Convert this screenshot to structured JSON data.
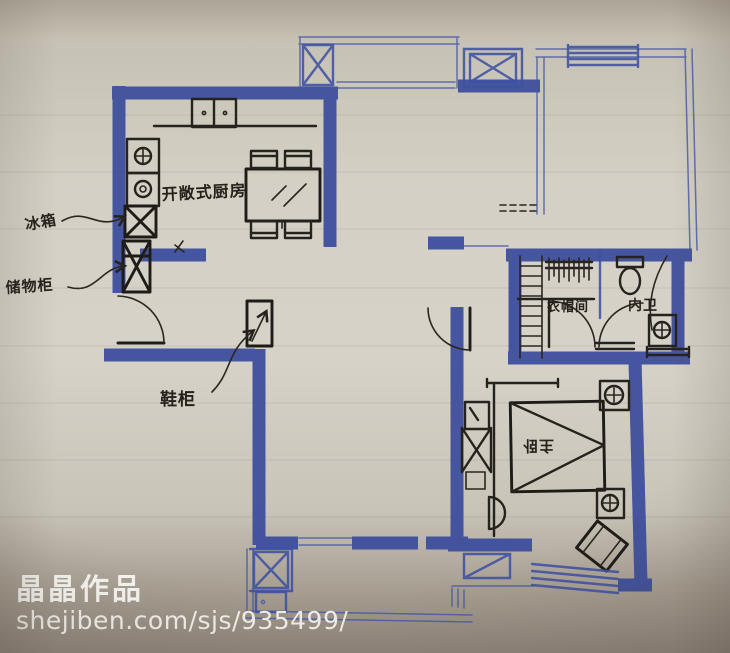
{
  "labels": {
    "kitchen": "开敞式厨房",
    "fridge": "冰箱",
    "storage_cabinet": "储物柜",
    "shoe_cabinet": "鞋柜",
    "walk_in_closet": "衣帽间",
    "inner_bathroom": "内卫",
    "master_bedroom": "主卧"
  },
  "watermark": {
    "title": "晶晶作品",
    "url": "shejiben.com/sjs/935499/"
  },
  "colors": {
    "wall_marker_blue": "#3d4e9c",
    "pen_blue": "#3f51a2",
    "ink_black": "#26221d",
    "paper": "#d4d0c5",
    "watermark_text": "#f7f5f1"
  }
}
